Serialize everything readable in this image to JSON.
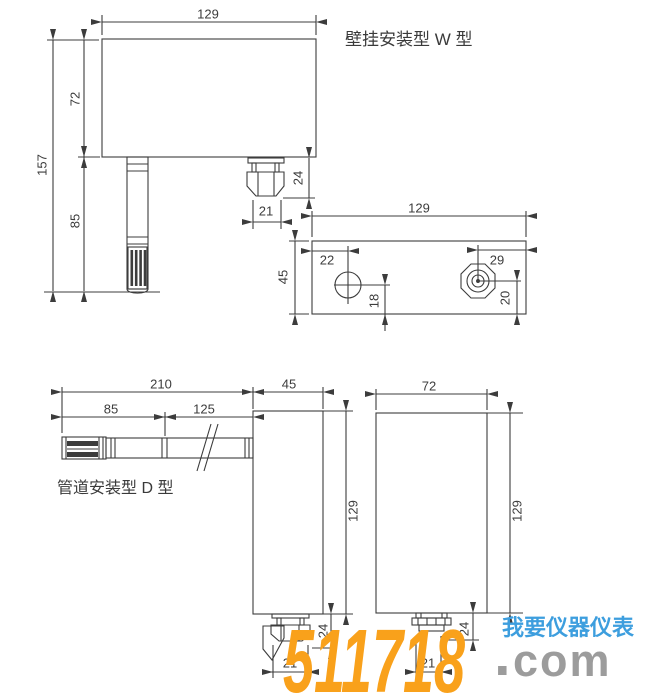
{
  "page": {
    "background": "#ffffff",
    "line_color": "#3c3c3c"
  },
  "wall_mount": {
    "title": "壁挂安装型 W 型",
    "front_view": {
      "width_mm": "129",
      "total_height_mm": "157",
      "body_height_mm": "72",
      "probe_length_mm": "85",
      "gland_height_mm": "24",
      "gland_width_mm": "21"
    },
    "bottom_view": {
      "width_mm": "129",
      "depth_mm": "45",
      "hole_from_left_mm": "22",
      "hole_from_bottom_mm": "18",
      "gland_from_right_mm": "29",
      "gland_from_bottom_mm": "20"
    }
  },
  "duct_mount": {
    "title": "管道安装型 D 型",
    "side_view": {
      "probe_total_mm": "210",
      "body_depth_mm": "45",
      "probe_head_mm": "85",
      "probe_shaft_mm": "125",
      "body_height_mm": "129",
      "gland_width_mm": "21",
      "gland_height_mm": "24"
    },
    "front_view": {
      "width_mm": "72",
      "height_mm": "129",
      "gland_width_mm": "21",
      "gland_height_mm": "24"
    }
  },
  "watermark": {
    "number": "511718",
    "separator": ".",
    "tld": "com",
    "slogan": "我要仪器仪表",
    "number_color": "#F9A11B",
    "tld_color": "#9c9c9c",
    "slogan_color": "#3D9EDE"
  }
}
